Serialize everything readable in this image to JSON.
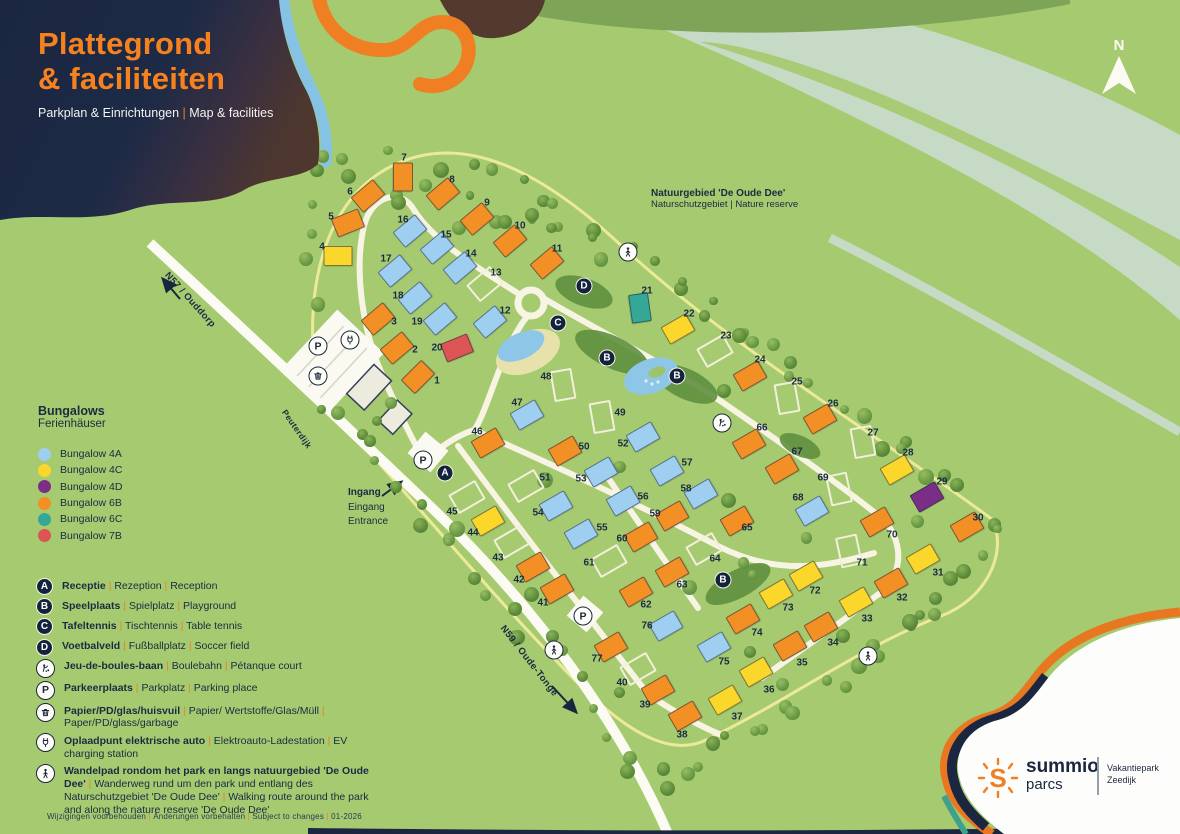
{
  "header": {
    "title_line1": "Plattegrond",
    "title_line2": "& faciliteiten",
    "subtitle_segments": [
      "Parkplan & Einrichtungen",
      "Map & facilities"
    ]
  },
  "north": {
    "label": "N"
  },
  "nature_label": {
    "bold": "Natuurgebied 'De Oude Dee'",
    "sub": "Naturschutzgebiet | Nature reserve"
  },
  "road_labels": {
    "n57": "N57 / Ouddorp",
    "dike": "Peuterdijk",
    "n59": "N59 / Oude-Tonge"
  },
  "entrance_label": {
    "lines": [
      "Ingang",
      "Eingang",
      "Entrance"
    ]
  },
  "bungalow_legend": {
    "title": "Bungalows",
    "subtitle": "Ferienhäuser",
    "items": [
      {
        "label": "Bungalow 4A",
        "type": "4A"
      },
      {
        "label": "Bungalow 4C",
        "type": "4C"
      },
      {
        "label": "Bungalow 4D",
        "type": "4D"
      },
      {
        "label": "Bungalow 6B",
        "type": "6B"
      },
      {
        "label": "Bungalow 6C",
        "type": "6C"
      },
      {
        "label": "Bungalow 7B",
        "type": "7B"
      }
    ]
  },
  "facility_legend": {
    "rows": [
      {
        "icon": "A",
        "style": "navy",
        "bold": "Receptie",
        "rest": [
          "Rezeption",
          "Reception"
        ]
      },
      {
        "icon": "B",
        "style": "navy",
        "bold": "Speelplaats",
        "rest": [
          "Spielplatz",
          "Playground"
        ]
      },
      {
        "icon": "C",
        "style": "navy",
        "bold": "Tafeltennis",
        "rest": [
          "Tischtennis",
          "Table tennis"
        ]
      },
      {
        "icon": "D",
        "style": "navy",
        "bold": "Voetbalveld",
        "rest": [
          "Fußballplatz",
          "Soccer field"
        ]
      },
      {
        "icon": "boules",
        "style": "white",
        "bold": "Jeu-de-boules-baan",
        "rest": [
          "Boulebahn",
          "Pétanque court"
        ]
      },
      {
        "icon": "P",
        "style": "white",
        "bold": "Parkeerplaats",
        "rest": [
          "Parkplatz",
          "Parking place"
        ]
      },
      {
        "icon": "trash",
        "style": "white",
        "bold": "Papier/PD/glas/huisvuil",
        "rest": [
          "Papier/ Wertstoffe/Glas/Müll",
          "Paper/PD/glass/garbage"
        ]
      },
      {
        "icon": "ev",
        "style": "white",
        "bold": "Oplaadpunt elektrische auto",
        "rest": [
          "Elektroauto-Ladestation",
          "EV charging station"
        ]
      },
      {
        "icon": "walk",
        "style": "white",
        "bold": "Wandelpad rondom het park en langs natuurgebied 'De Oude Dee'",
        "rest": [
          "Wanderweg rund um den park und entlang des Naturschutzgebiet 'De Oude Dee'",
          "Walking route around the park and along the nature reserve 'De Oude Dee'"
        ]
      }
    ]
  },
  "footer": {
    "segments": [
      "Wijzigingen voorbehouden",
      "Änderungen vorbehalten",
      "Subject to changes",
      "01-2026"
    ]
  },
  "brand": {
    "line1": "summio",
    "line2": "parcs",
    "park1": "Vakantiepark",
    "park2": "Zeedijk",
    "sun_letter": "S"
  },
  "map": {
    "colors": {
      "4A": "#9FCFF0",
      "4C": "#FBD62B",
      "4D": "#7B2E85",
      "6B": "#F28F25",
      "6C": "#34A796",
      "7B": "#DC5454",
      "plot": "#F2EFDC"
    },
    "bungalows": [
      {
        "n": 1,
        "t": "6B",
        "x": 418,
        "y": 377,
        "r": -45,
        "lx": 437,
        "ly": 381
      },
      {
        "n": 2,
        "t": "6B",
        "x": 397,
        "y": 348,
        "r": -40,
        "lx": 415,
        "ly": 350
      },
      {
        "n": 3,
        "t": "6B",
        "x": 378,
        "y": 319,
        "r": -40,
        "lx": 394,
        "ly": 322
      },
      {
        "n": 4,
        "t": "4C",
        "x": 338,
        "y": 256,
        "r": 0,
        "lx": 322,
        "ly": 247
      },
      {
        "n": 5,
        "t": "6B",
        "x": 348,
        "y": 223,
        "r": -22,
        "lx": 331,
        "ly": 217
      },
      {
        "n": 6,
        "t": "6B",
        "x": 368,
        "y": 196,
        "r": -40,
        "lx": 350,
        "ly": 192
      },
      {
        "n": 7,
        "t": "6B",
        "x": 403,
        "y": 177,
        "r": 90,
        "lx": 404,
        "ly": 158
      },
      {
        "n": 8,
        "t": "6B",
        "x": 443,
        "y": 194,
        "r": -40,
        "lx": 452,
        "ly": 180
      },
      {
        "n": 9,
        "t": "6B",
        "x": 477,
        "y": 219,
        "r": -40,
        "lx": 487,
        "ly": 203
      },
      {
        "n": 10,
        "t": "6B",
        "x": 510,
        "y": 241,
        "r": -40,
        "lx": 520,
        "ly": 226
      },
      {
        "n": 11,
        "t": "6B",
        "x": 547,
        "y": 263,
        "r": -40,
        "lx": 557,
        "ly": 249
      },
      {
        "n": 12,
        "t": "4A",
        "x": 490,
        "y": 322,
        "r": -40,
        "lx": 505,
        "ly": 311
      },
      {
        "n": 13,
        "t": "PL",
        "x": 485,
        "y": 284,
        "r": -40,
        "lx": 496,
        "ly": 273
      },
      {
        "n": 14,
        "t": "4A",
        "x": 460,
        "y": 268,
        "r": -40,
        "lx": 471,
        "ly": 254
      },
      {
        "n": 15,
        "t": "4A",
        "x": 437,
        "y": 248,
        "r": -40,
        "lx": 446,
        "ly": 235
      },
      {
        "n": 16,
        "t": "4A",
        "x": 410,
        "y": 231,
        "r": -40,
        "lx": 403,
        "ly": 220
      },
      {
        "n": 17,
        "t": "4A",
        "x": 395,
        "y": 271,
        "r": -40,
        "lx": 386,
        "ly": 259
      },
      {
        "n": 18,
        "t": "4A",
        "x": 415,
        "y": 298,
        "r": -40,
        "lx": 398,
        "ly": 296
      },
      {
        "n": 19,
        "t": "4A",
        "x": 440,
        "y": 319,
        "r": -40,
        "lx": 417,
        "ly": 322
      },
      {
        "n": 20,
        "t": "7B",
        "x": 457,
        "y": 348,
        "r": -22,
        "lx": 437,
        "ly": 348
      },
      {
        "n": 21,
        "t": "6C",
        "x": 640,
        "y": 308,
        "r": 82,
        "lx": 647,
        "ly": 291
      },
      {
        "n": 22,
        "t": "4C",
        "x": 678,
        "y": 329,
        "r": -30,
        "lx": 689,
        "ly": 314
      },
      {
        "n": 23,
        "t": "PL",
        "x": 715,
        "y": 351,
        "r": -30,
        "lx": 726,
        "ly": 336
      },
      {
        "n": 24,
        "t": "6B",
        "x": 750,
        "y": 376,
        "r": -30,
        "lx": 760,
        "ly": 360
      },
      {
        "n": 25,
        "t": "PL",
        "x": 787,
        "y": 398,
        "r": 80,
        "lx": 797,
        "ly": 382
      },
      {
        "n": 26,
        "t": "6B",
        "x": 820,
        "y": 419,
        "r": -30,
        "lx": 833,
        "ly": 404
      },
      {
        "n": 27,
        "t": "PL",
        "x": 863,
        "y": 442,
        "r": 80,
        "lx": 873,
        "ly": 433
      },
      {
        "n": 28,
        "t": "4C",
        "x": 897,
        "y": 470,
        "r": -30,
        "lx": 908,
        "ly": 453
      },
      {
        "n": 29,
        "t": "4D",
        "x": 927,
        "y": 497,
        "r": -30,
        "lx": 942,
        "ly": 482
      },
      {
        "n": 30,
        "t": "6B",
        "x": 967,
        "y": 527,
        "r": -30,
        "lx": 978,
        "ly": 518
      },
      {
        "n": 31,
        "t": "4C",
        "x": 923,
        "y": 559,
        "r": -30,
        "lx": 938,
        "ly": 573
      },
      {
        "n": 32,
        "t": "6B",
        "x": 891,
        "y": 583,
        "r": -30,
        "lx": 902,
        "ly": 598
      },
      {
        "n": 33,
        "t": "4C",
        "x": 856,
        "y": 602,
        "r": -30,
        "lx": 867,
        "ly": 619
      },
      {
        "n": 34,
        "t": "6B",
        "x": 821,
        "y": 627,
        "r": -30,
        "lx": 833,
        "ly": 643
      },
      {
        "n": 35,
        "t": "6B",
        "x": 790,
        "y": 646,
        "r": -30,
        "lx": 802,
        "ly": 663
      },
      {
        "n": 36,
        "t": "4C",
        "x": 756,
        "y": 672,
        "r": -30,
        "lx": 769,
        "ly": 690
      },
      {
        "n": 37,
        "t": "4C",
        "x": 725,
        "y": 700,
        "r": -30,
        "lx": 737,
        "ly": 717
      },
      {
        "n": 38,
        "t": "6B",
        "x": 685,
        "y": 716,
        "r": -30,
        "lx": 682,
        "ly": 735
      },
      {
        "n": 39,
        "t": "6B",
        "x": 658,
        "y": 690,
        "r": -30,
        "lx": 645,
        "ly": 705
      },
      {
        "n": 40,
        "t": "PL",
        "x": 638,
        "y": 669,
        "r": -30,
        "lx": 622,
        "ly": 683
      },
      {
        "n": 41,
        "t": "6B",
        "x": 557,
        "y": 589,
        "r": -30,
        "lx": 543,
        "ly": 603
      },
      {
        "n": 42,
        "t": "6B",
        "x": 533,
        "y": 567,
        "r": -30,
        "lx": 519,
        "ly": 580
      },
      {
        "n": 43,
        "t": "PL",
        "x": 512,
        "y": 542,
        "r": -30,
        "lx": 498,
        "ly": 558
      },
      {
        "n": 44,
        "t": "4C",
        "x": 488,
        "y": 521,
        "r": -30,
        "lx": 473,
        "ly": 533
      },
      {
        "n": 45,
        "t": "PL",
        "x": 467,
        "y": 497,
        "r": -30,
        "lx": 452,
        "ly": 512
      },
      {
        "n": 46,
        "t": "6B",
        "x": 488,
        "y": 443,
        "r": -30,
        "lx": 477,
        "ly": 432
      },
      {
        "n": 47,
        "t": "4A",
        "x": 527,
        "y": 415,
        "r": -30,
        "lx": 517,
        "ly": 403
      },
      {
        "n": 48,
        "t": "PL",
        "x": 563,
        "y": 385,
        "r": 80,
        "lx": 546,
        "ly": 377
      },
      {
        "n": 49,
        "t": "PL",
        "x": 602,
        "y": 417,
        "r": 80,
        "lx": 620,
        "ly": 413
      },
      {
        "n": 50,
        "t": "6B",
        "x": 565,
        "y": 451,
        "r": -30,
        "lx": 584,
        "ly": 447
      },
      {
        "n": 51,
        "t": "PL",
        "x": 526,
        "y": 486,
        "r": -30,
        "lx": 545,
        "ly": 478
      },
      {
        "n": 52,
        "t": "4A",
        "x": 643,
        "y": 437,
        "r": -30,
        "lx": 623,
        "ly": 444
      },
      {
        "n": 53,
        "t": "4A",
        "x": 601,
        "y": 472,
        "r": -30,
        "lx": 581,
        "ly": 479
      },
      {
        "n": 54,
        "t": "4A",
        "x": 556,
        "y": 506,
        "r": -30,
        "lx": 538,
        "ly": 513
      },
      {
        "n": 55,
        "t": "4A",
        "x": 581,
        "y": 534,
        "r": -30,
        "lx": 602,
        "ly": 528
      },
      {
        "n": 56,
        "t": "4A",
        "x": 623,
        "y": 501,
        "r": -30,
        "lx": 643,
        "ly": 497
      },
      {
        "n": 57,
        "t": "4A",
        "x": 667,
        "y": 471,
        "r": -30,
        "lx": 687,
        "ly": 463
      },
      {
        "n": 58,
        "t": "4A",
        "x": 701,
        "y": 494,
        "r": -30,
        "lx": 686,
        "ly": 489
      },
      {
        "n": 59,
        "t": "6B",
        "x": 672,
        "y": 516,
        "r": -30,
        "lx": 655,
        "ly": 514
      },
      {
        "n": 60,
        "t": "6B",
        "x": 641,
        "y": 537,
        "r": -30,
        "lx": 622,
        "ly": 539
      },
      {
        "n": 61,
        "t": "PL",
        "x": 609,
        "y": 561,
        "r": -30,
        "lx": 589,
        "ly": 563
      },
      {
        "n": 62,
        "t": "6B",
        "x": 636,
        "y": 592,
        "r": -30,
        "lx": 646,
        "ly": 605
      },
      {
        "n": 63,
        "t": "6B",
        "x": 672,
        "y": 572,
        "r": -30,
        "lx": 682,
        "ly": 585
      },
      {
        "n": 64,
        "t": "PL",
        "x": 704,
        "y": 549,
        "r": -30,
        "lx": 715,
        "ly": 559
      },
      {
        "n": 65,
        "t": "6B",
        "x": 737,
        "y": 521,
        "r": -30,
        "lx": 747,
        "ly": 528
      },
      {
        "n": 66,
        "t": "6B",
        "x": 749,
        "y": 444,
        "r": -30,
        "lx": 762,
        "ly": 428
      },
      {
        "n": 67,
        "t": "6B",
        "x": 782,
        "y": 469,
        "r": -30,
        "lx": 797,
        "ly": 452
      },
      {
        "n": 68,
        "t": "4A",
        "x": 812,
        "y": 511,
        "r": -30,
        "lx": 798,
        "ly": 498
      },
      {
        "n": 69,
        "t": "PL",
        "x": 839,
        "y": 489,
        "r": 78,
        "lx": 823,
        "ly": 478
      },
      {
        "n": 70,
        "t": "6B",
        "x": 877,
        "y": 522,
        "r": -30,
        "lx": 892,
        "ly": 535
      },
      {
        "n": 71,
        "t": "PL",
        "x": 849,
        "y": 551,
        "r": 78,
        "lx": 862,
        "ly": 563
      },
      {
        "n": 72,
        "t": "4C",
        "x": 806,
        "y": 576,
        "r": -30,
        "lx": 815,
        "ly": 591
      },
      {
        "n": 73,
        "t": "4C",
        "x": 776,
        "y": 594,
        "r": -30,
        "lx": 788,
        "ly": 608
      },
      {
        "n": 74,
        "t": "6B",
        "x": 743,
        "y": 619,
        "r": -30,
        "lx": 757,
        "ly": 633
      },
      {
        "n": 75,
        "t": "4A",
        "x": 714,
        "y": 647,
        "r": -30,
        "lx": 724,
        "ly": 662
      },
      {
        "n": 76,
        "t": "4A",
        "x": 666,
        "y": 626,
        "r": -30,
        "lx": 647,
        "ly": 626
      },
      {
        "n": 77,
        "t": "6B",
        "x": 611,
        "y": 647,
        "r": -30,
        "lx": 597,
        "ly": 659
      }
    ],
    "facilities": [
      {
        "icon": "A",
        "style": "navy",
        "x": 445,
        "y": 473
      },
      {
        "icon": "B",
        "style": "navy",
        "x": 607,
        "y": 358
      },
      {
        "icon": "B",
        "style": "navy",
        "x": 677,
        "y": 376
      },
      {
        "icon": "B",
        "style": "navy",
        "x": 723,
        "y": 580
      },
      {
        "icon": "C",
        "style": "navy",
        "x": 558,
        "y": 323
      },
      {
        "icon": "D",
        "style": "navy",
        "x": 584,
        "y": 286
      },
      {
        "icon": "P",
        "style": "white",
        "x": 318,
        "y": 346
      },
      {
        "icon": "P",
        "style": "white",
        "x": 423,
        "y": 460
      },
      {
        "icon": "P",
        "style": "white",
        "x": 583,
        "y": 616
      },
      {
        "icon": "trash",
        "style": "white",
        "x": 318,
        "y": 376
      },
      {
        "icon": "ev",
        "style": "white",
        "x": 350,
        "y": 340
      },
      {
        "icon": "boules",
        "style": "white",
        "x": 722,
        "y": 423
      },
      {
        "icon": "walk",
        "style": "white",
        "x": 628,
        "y": 252
      },
      {
        "icon": "walk",
        "style": "white",
        "x": 554,
        "y": 650
      },
      {
        "icon": "walk",
        "style": "white",
        "x": 868,
        "y": 656
      }
    ]
  }
}
